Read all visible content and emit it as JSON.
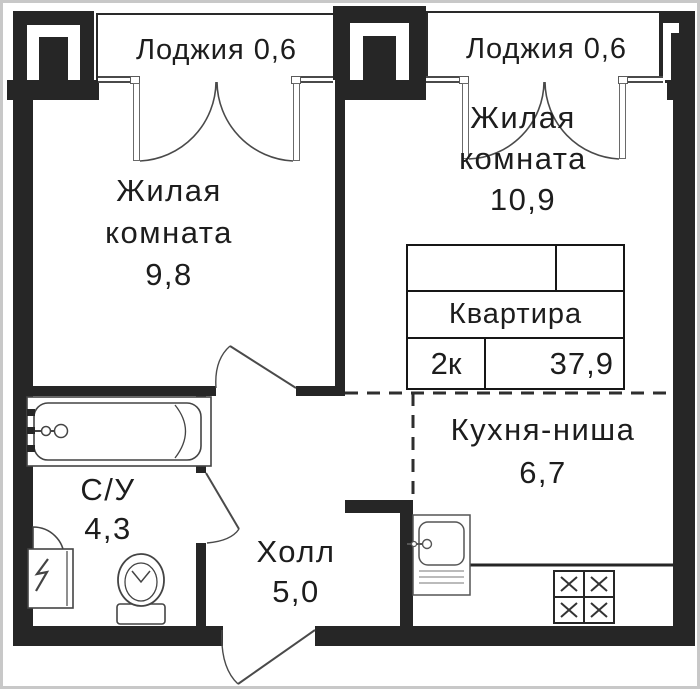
{
  "plan": {
    "loggia_left": {
      "label": "Лоджия 0,6"
    },
    "loggia_right": {
      "label": "Лоджия 0,6"
    },
    "living_room_left": {
      "name_line1": "Жилая",
      "name_line2": "комната",
      "area": "9,8"
    },
    "living_room_right": {
      "name_line1": "Жилая",
      "name_line2": "комната",
      "area": "10,9"
    },
    "kitchen_niche": {
      "name": "Кухня-ниша",
      "area": "6,7"
    },
    "bathroom": {
      "name": "С/У",
      "area": "4,3"
    },
    "hall": {
      "name": "Холл",
      "area": "5,0"
    },
    "info_table": {
      "title": "Квартира",
      "rooms_label": "2к",
      "total_area": "37,9"
    }
  },
  "fixtures": {
    "bathtub": "bathtub-icon",
    "washbasin": "washbasin-icon",
    "toilet": "toilet-icon",
    "washing_machine": "washing-machine-icon",
    "kitchen_sink": "kitchen-sink-icon",
    "stove": "stove-burners-icon"
  },
  "colors": {
    "wall": "#262626",
    "line": "#3f3f3f",
    "dashed_boundary": "#2e2e2e",
    "frame": "#c8c8c8",
    "background": "#ffffff"
  }
}
